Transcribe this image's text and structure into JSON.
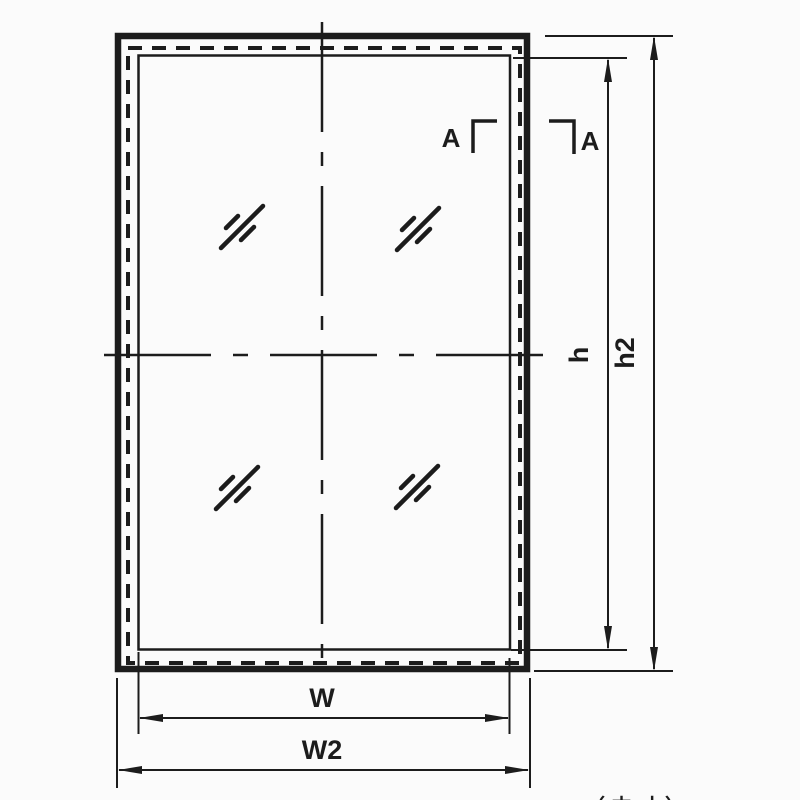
{
  "drawing": {
    "type": "window-frame-elevation",
    "colors": {
      "ink": "#1c1c1c",
      "background": "#fbfbfb"
    },
    "dimensions": {
      "inner_width_label": "W",
      "outer_width_label": "W2",
      "inner_height_label": "h",
      "outer_height_label": "h2"
    },
    "section_marks": {
      "left_label": "A",
      "right_label": "A"
    },
    "notes": {
      "clipped_note": "（内寸）"
    }
  }
}
